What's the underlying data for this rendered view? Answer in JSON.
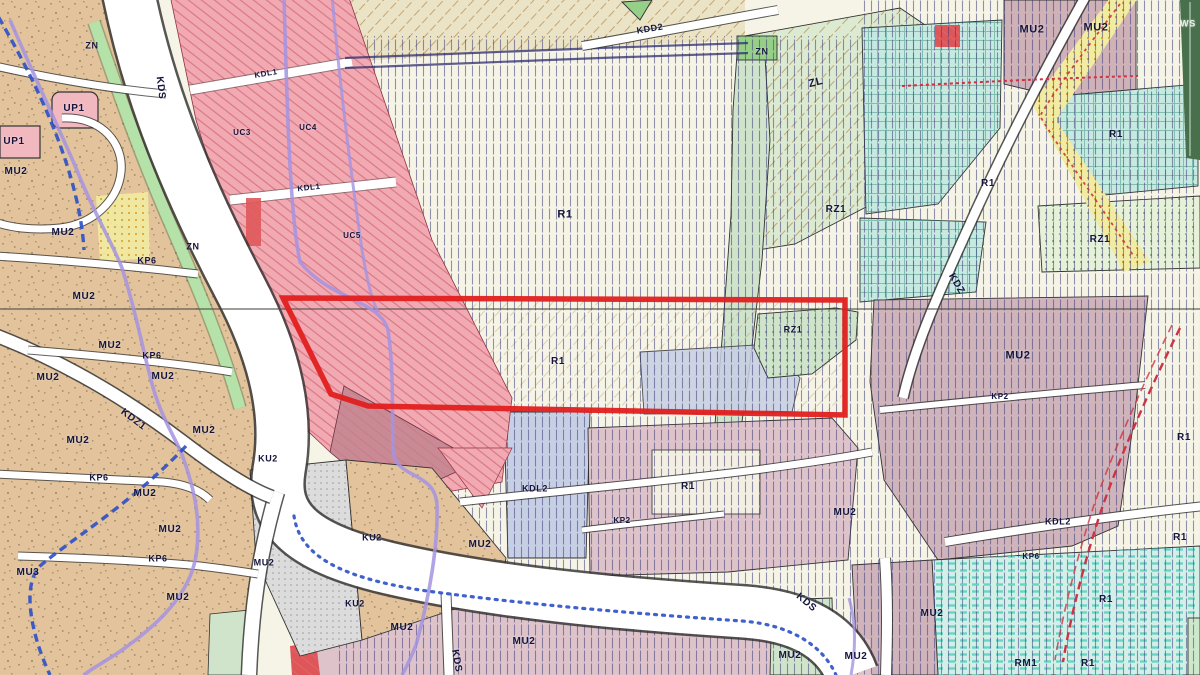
{
  "map": {
    "type": "zoning-plan-map",
    "palette": {
      "cream": "#f5f2e2",
      "field": "#f6f4e6",
      "tan": "#e2c39c",
      "pink-band": "#f2aab2",
      "red-hatch": "#d4697a",
      "navyhatch": "#3c3c78",
      "green-strip": "#b4e2a8",
      "zl-green": "#dcead2",
      "tongue-green": "#cfe4cb",
      "zn-green": "#96cf87",
      "teal": "#c6e9e0",
      "teal-dash-bg": "#d3efe8",
      "teal-line": "#55cfc0",
      "check-line": "#3f8f82",
      "mauve": "#cfb4bc",
      "mauve-top": "#cfb2b8",
      "pink-block": "#dec4ca",
      "gray-ku": "#dcdcdc",
      "bluegray": "#c7cfe4",
      "yellow": "#f1eca2",
      "yellow-dot": "#d79b25",
      "rz-green": "#e7f1d9",
      "green-dot": "#6aa060",
      "ws-green": "#49704c",
      "road": "#ffffff",
      "casing": "#2e2e2e",
      "brown-hatch": "#b48a50",
      "highlight": "#e01f1f",
      "stream": "#a393e0",
      "blue-dash": "#2b50c8",
      "red-dash": "#cc3344",
      "label": "#14143c",
      "up-pink": "#f2b8c0",
      "rose": "#c88b95",
      "red-bit": "#e05555",
      "speckle": "#7a6648"
    },
    "highlight": {
      "points": "283,298 845,300 845,415 368,406 331,394"
    },
    "labels": [
      {
        "t": "ZN",
        "x": 92,
        "y": 46,
        "s": 9
      },
      {
        "t": "KDS",
        "x": 160,
        "y": 88,
        "s": 10,
        "r": 83
      },
      {
        "t": "UP1",
        "x": 74,
        "y": 109,
        "s": 10
      },
      {
        "t": "UP1",
        "x": 14,
        "y": 142,
        "s": 10
      },
      {
        "t": "MU2",
        "x": 16,
        "y": 172,
        "s": 10
      },
      {
        "t": "UC3",
        "x": 242,
        "y": 133,
        "s": 8
      },
      {
        "t": "UC4",
        "x": 308,
        "y": 128,
        "s": 8
      },
      {
        "t": "KDL1",
        "x": 266,
        "y": 74,
        "s": 8,
        "r": -10
      },
      {
        "t": "KDL1",
        "x": 309,
        "y": 188,
        "s": 8,
        "r": -6
      },
      {
        "t": "UC5",
        "x": 352,
        "y": 236,
        "s": 8
      },
      {
        "t": "MU2",
        "x": 63,
        "y": 233,
        "s": 10
      },
      {
        "t": "ZN",
        "x": 193,
        "y": 247,
        "s": 9
      },
      {
        "t": "KP6",
        "x": 147,
        "y": 261,
        "s": 9
      },
      {
        "t": "MU2",
        "x": 84,
        "y": 297,
        "s": 10
      },
      {
        "t": "MU2",
        "x": 110,
        "y": 346,
        "s": 10
      },
      {
        "t": "KP6",
        "x": 152,
        "y": 356,
        "s": 9
      },
      {
        "t": "MU2",
        "x": 48,
        "y": 378,
        "s": 10
      },
      {
        "t": "MU2",
        "x": 163,
        "y": 377,
        "s": 10
      },
      {
        "t": "KDZ1",
        "x": 133,
        "y": 420,
        "s": 10,
        "r": 37
      },
      {
        "t": "MU2",
        "x": 204,
        "y": 431,
        "s": 10
      },
      {
        "t": "MU2",
        "x": 78,
        "y": 441,
        "s": 10
      },
      {
        "t": "KU2",
        "x": 268,
        "y": 459,
        "s": 9
      },
      {
        "t": "KP6",
        "x": 99,
        "y": 478,
        "s": 9
      },
      {
        "t": "MU2",
        "x": 145,
        "y": 494,
        "s": 10
      },
      {
        "t": "MU2",
        "x": 170,
        "y": 530,
        "s": 10
      },
      {
        "t": "KP6",
        "x": 158,
        "y": 559,
        "s": 9
      },
      {
        "t": "MU2",
        "x": 264,
        "y": 563,
        "s": 9
      },
      {
        "t": "MU3",
        "x": 28,
        "y": 573,
        "s": 10
      },
      {
        "t": "MU2",
        "x": 178,
        "y": 598,
        "s": 10
      },
      {
        "t": "KDD2",
        "x": 650,
        "y": 29,
        "s": 9,
        "r": -9
      },
      {
        "t": "ZN",
        "x": 762,
        "y": 52,
        "s": 9
      },
      {
        "t": "ZL",
        "x": 816,
        "y": 83,
        "s": 11,
        "r": -14
      },
      {
        "t": "RZ1",
        "x": 836,
        "y": 210,
        "s": 10
      },
      {
        "t": "R1",
        "x": 565,
        "y": 215,
        "s": 11
      },
      {
        "t": "R1",
        "x": 558,
        "y": 362,
        "s": 10
      },
      {
        "t": "RZ1",
        "x": 793,
        "y": 330,
        "s": 9
      },
      {
        "t": "MU2",
        "x": 1032,
        "y": 30,
        "s": 11
      },
      {
        "t": "MU2",
        "x": 1096,
        "y": 28,
        "s": 11
      },
      {
        "t": "WS",
        "x": 1188,
        "y": 24,
        "s": 9,
        "c": "#eaf2ea"
      },
      {
        "t": "R1",
        "x": 1116,
        "y": 135,
        "s": 10
      },
      {
        "t": "R1",
        "x": 988,
        "y": 184,
        "s": 10
      },
      {
        "t": "RZ1",
        "x": 1100,
        "y": 240,
        "s": 10
      },
      {
        "t": "KDZ",
        "x": 956,
        "y": 284,
        "s": 10,
        "r": 60
      },
      {
        "t": "MU2",
        "x": 1018,
        "y": 356,
        "s": 11
      },
      {
        "t": "KP2",
        "x": 1000,
        "y": 397,
        "s": 8
      },
      {
        "t": "R1",
        "x": 1184,
        "y": 438,
        "s": 10
      },
      {
        "t": "KDL2",
        "x": 535,
        "y": 489,
        "s": 9
      },
      {
        "t": "KP2",
        "x": 622,
        "y": 521,
        "s": 8
      },
      {
        "t": "MU2",
        "x": 480,
        "y": 545,
        "s": 10
      },
      {
        "t": "R1",
        "x": 688,
        "y": 487,
        "s": 10
      },
      {
        "t": "MU2",
        "x": 845,
        "y": 513,
        "s": 10
      },
      {
        "t": "KU2",
        "x": 372,
        "y": 538,
        "s": 9
      },
      {
        "t": "KU2",
        "x": 355,
        "y": 604,
        "s": 9
      },
      {
        "t": "MU2",
        "x": 402,
        "y": 628,
        "s": 10
      },
      {
        "t": "MU2",
        "x": 524,
        "y": 642,
        "s": 10
      },
      {
        "t": "KDS",
        "x": 456,
        "y": 661,
        "s": 10,
        "r": 80
      },
      {
        "t": "KDS",
        "x": 806,
        "y": 603,
        "s": 10,
        "r": 40
      },
      {
        "t": "MU2",
        "x": 790,
        "y": 656,
        "s": 10
      },
      {
        "t": "MU2",
        "x": 932,
        "y": 614,
        "s": 10
      },
      {
        "t": "MU2",
        "x": 856,
        "y": 657,
        "s": 10
      },
      {
        "t": "KDL2",
        "x": 1058,
        "y": 522,
        "s": 9
      },
      {
        "t": "KP6",
        "x": 1031,
        "y": 557,
        "s": 8
      },
      {
        "t": "R1",
        "x": 1180,
        "y": 538,
        "s": 10
      },
      {
        "t": "R1",
        "x": 1106,
        "y": 600,
        "s": 10
      },
      {
        "t": "RM1",
        "x": 1026,
        "y": 664,
        "s": 10
      },
      {
        "t": "R1",
        "x": 1088,
        "y": 664,
        "s": 10
      }
    ]
  }
}
